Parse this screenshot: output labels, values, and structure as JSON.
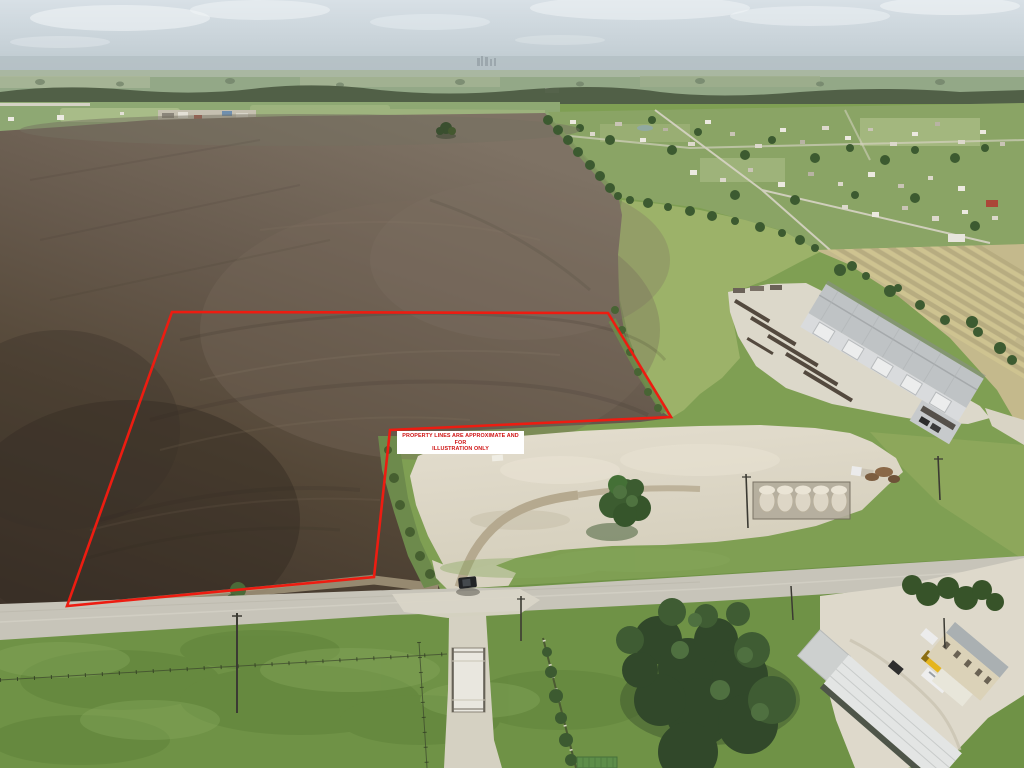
{
  "overlay": {
    "disclaimer_line1": "PROPERTY LINES ARE APPROXIMATE AND FOR",
    "disclaimer_line2": "ILLUSTRATION ONLY"
  },
  "annotation": {
    "boundary_points": "172,312 608,313 671,417 390,430 374,577 67,606",
    "boundary_color": "#ed1c11",
    "boundary_width": "2.6"
  },
  "scene": {
    "description": "aerial drone photo of vacant farm land with outlined parcel",
    "palette": {
      "sky": "#ccd7de",
      "haze": "#b4c0c4",
      "distant_green": "#93a887",
      "treeline": "#4d5c43",
      "field_dark": "#3e332a",
      "field_light": "#7e7264",
      "pasture": "#a0b46c",
      "grass": "#7f9f53",
      "grass_dark": "#6f9246",
      "pad": "#ded8c8",
      "road": "#c7c4b9",
      "yard": "#dcd8ca",
      "roof_grey": "#bfc3c5",
      "roof_white": "#e3e5e4",
      "wall": "#d9dbdd",
      "tank": "#ddd6c6",
      "tree": "#3c5a30",
      "house_tan": "#dbd2b8",
      "container_red": "#a83226",
      "truck_yellow": "#e5b51e",
      "disclaimer_bg": "#ffffff",
      "disclaimer_fg": "#cf1414"
    }
  }
}
